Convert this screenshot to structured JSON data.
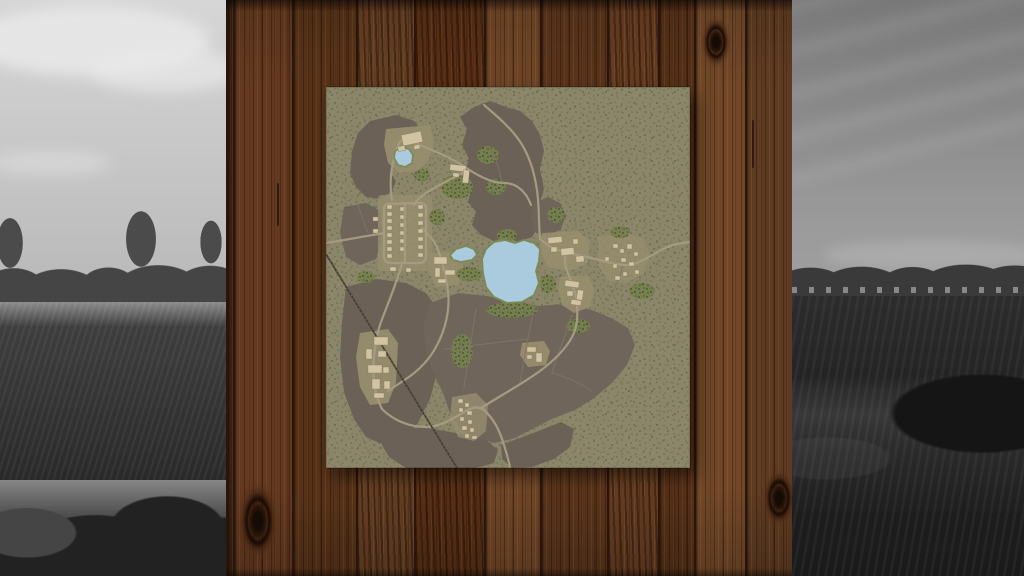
{
  "scene": {
    "width": 1024,
    "height": 576
  },
  "left_landscape": {
    "sky_top": "#d6d6d6",
    "sky_bottom": "#c0c0c0",
    "cloud": "#e9e9e9",
    "treeline": "#454545",
    "mist": "#8c8c8c",
    "field": "#3e3e3e",
    "field_dark": "#2a2a2a",
    "bush": "#222222"
  },
  "right_landscape": {
    "sky_top": "#787878",
    "sky_bottom": "#9b9b9b",
    "treeline": "#3a3a3a",
    "buildings": "#c8c8c8",
    "field": "#2c2c2c",
    "ridge": "#383838",
    "field_dark": "#1d1d1d"
  },
  "wall": {
    "x": 226,
    "width": 566,
    "seam": "#2a150a",
    "planks": [
      {
        "x": 226,
        "w": 7,
        "tone": "#3a2112"
      },
      {
        "x": 233,
        "w": 59,
        "tone": "#64391f"
      },
      {
        "x": 292,
        "w": 64,
        "tone": "#573218"
      },
      {
        "x": 356,
        "w": 58,
        "tone": "#6a4124",
        "streak": true
      },
      {
        "x": 414,
        "w": 70,
        "tone": "#5d3116",
        "streak": true
      },
      {
        "x": 484,
        "w": 56,
        "tone": "#6f4526"
      },
      {
        "x": 540,
        "w": 67,
        "tone": "#5a341b"
      },
      {
        "x": 607,
        "w": 51,
        "tone": "#6b3f22",
        "streak": true
      },
      {
        "x": 658,
        "w": 36,
        "tone": "#553017"
      },
      {
        "x": 694,
        "w": 51,
        "tone": "#714727"
      },
      {
        "x": 745,
        "w": 47,
        "tone": "#5e3a20"
      }
    ],
    "knots": [
      {
        "cx": 716,
        "cy": 42,
        "rx": 20,
        "ry": 34
      },
      {
        "cx": 258,
        "cy": 521,
        "rx": 27,
        "ry": 52
      },
      {
        "cx": 779,
        "cy": 498,
        "rx": 22,
        "ry": 38
      }
    ],
    "cracks": [
      {
        "x": 277,
        "y1": 183,
        "y2": 226
      },
      {
        "x": 752,
        "y1": 120,
        "y2": 168
      }
    ]
  },
  "map_poster": {
    "x": 326,
    "y": 87,
    "width": 364,
    "height": 381,
    "colors": {
      "ground": "#8b866a",
      "speckle": "#565c3b",
      "field": "#6b6156",
      "field_alt": "#6f655a",
      "clearing": "#978d6e",
      "shrub": "#76804d",
      "shrub_dot": "#49572f",
      "road": "#a59b82",
      "track": "#7f7567",
      "rail": "#443f32",
      "water": "#a9cbdd",
      "shore": "#7d8a55",
      "building": "#d0c4a2",
      "building_edge": "#877c60"
    },
    "fields": [
      {
        "d": "M 44,34 L 70,28 L 88,34 L 96,44 L 90,52 L 76,50 L 66,56 L 64,66 L 68,76 L 64,86 L 70,94 L 66,104 L 54,112 L 40,110 L 30,100 L 24,86 L 26,64 L 32,46 Z"
      },
      {
        "d": "M 134,30 L 148,20 L 164,14 L 180,20 L 194,24 L 206,34 L 214,48 L 218,64 L 214,82 L 218,102 L 212,122 L 215,136 L 206,150 L 192,155 L 180,150 L 168,154 L 155,148 L 146,138 L 150,125 L 142,115 L 146,100 L 138,88 L 143,72 L 136,58 L 141,42 Z"
      },
      {
        "d": "M 18,120 L 40,116 L 54,124 L 56,150 L 50,172 L 34,178 L 20,170 L 14,146 Z",
        "alt": true
      },
      {
        "d": "M 20,200 L 50,192 L 80,196 L 100,206 L 112,222 L 110,252 L 112,282 L 104,312 L 92,336 L 78,352 L 58,358 L 40,350 L 28,332 L 18,305 L 14,270 L 16,235 Z"
      },
      {
        "d": "M 104,216 L 132,206 L 160,209 L 186,213 L 212,219 L 240,217 L 266,223 L 285,231 L 302,241 L 309,258 L 301,278 L 286,296 L 268,311 L 249,323 L 228,331 L 208,341 L 189,351 L 169,356 L 149,351 L 134,341 L 124,326 L 117,306 L 108,288 L 100,264 L 97,240 Z",
        "alt": true
      },
      {
        "d": "M 62,346 L 96,340 L 130,346 L 160,353 L 172,363 L 168,376 L 150,381 L 80,381 L 63,370 L 56,358 Z"
      },
      {
        "d": "M 208,116 L 222,110 L 234,116 L 240,128 L 235,142 L 222,149 L 210,146 L 205,130 Z",
        "alt": true
      },
      {
        "d": "M 175,358 L 210,345 L 235,335 L 248,342 L 244,360 L 228,372 L 206,380 L 186,381 L 176,372 Z"
      }
    ],
    "clearings": [
      {
        "d": "M 60,42 L 104,38 L 108,56 L 102,74 L 92,84 L 74,86 L 62,76 L 58,58 Z"
      },
      {
        "d": "M 56,108 L 102,108 Q 106,108 106,112 L 106,180 Q 106,184 102,184 L 56,184 Q 52,184 52,180 L 52,112 Q 52,108 56,108 Z",
        "o": 0.8
      },
      {
        "d": "M 104,166 L 134,164 L 138,182 L 132,198 L 110,200 L 102,184 Z"
      },
      {
        "d": "M 216,146 L 252,144 L 264,154 L 262,176 L 244,184 L 222,180 L 214,162 Z"
      },
      {
        "d": "M 272,150 L 300,146 L 318,152 L 324,168 L 318,186 L 300,196 L 282,194 L 272,178 Z",
        "o": 0.75
      },
      {
        "d": "M 234,190 L 262,188 L 268,202 L 264,220 L 248,226 L 236,218 L 232,202 Z"
      },
      {
        "d": "M 34,246 L 62,242 L 72,256 L 70,296 L 62,316 L 44,318 L 34,300 L 30,270 Z"
      },
      {
        "d": "M 126,310 L 150,306 L 162,318 L 160,344 L 148,354 L 132,350 L 124,332 Z",
        "o": 0.8
      },
      {
        "d": "M 196,256 L 218,254 L 224,264 L 220,278 L 202,280 L 194,268 Z"
      }
    ],
    "shrubs": [
      [
        131,
        100,
        16,
        12
      ],
      [
        162,
        68,
        11,
        9
      ],
      [
        170,
        100,
        10,
        8
      ],
      [
        186,
        223,
        26,
        8
      ],
      [
        143,
        187,
        13,
        7
      ],
      [
        136,
        264,
        11,
        17
      ],
      [
        316,
        204,
        13,
        8
      ],
      [
        252,
        239,
        12,
        7
      ],
      [
        222,
        197,
        8,
        9
      ],
      [
        96,
        88,
        8,
        6
      ],
      [
        40,
        190,
        9,
        6
      ],
      [
        294,
        145,
        10,
        6
      ],
      [
        111,
        130,
        8,
        8
      ],
      [
        230,
        128,
        9,
        8
      ],
      [
        181,
        148,
        10,
        6
      ]
    ],
    "tracks": [
      "M 150,222 C 146,248 142,274 138,300",
      "M 208,222 C 202,248 198,272 194,296",
      "M 246,228 C 238,250 232,268 226,286",
      "M 118,262 L 200,252",
      "M 284,210 C 290,200 294,190 297,178",
      "M 176,96 C 174,84 170,72 164,60",
      "M 30,112 C 34,124 38,136 42,146",
      "M 226,286 C 240,290 254,296 266,304"
    ],
    "roads": [
      "M 78,52 C 98,60 122,68 142,82 C 154,90 166,96 178,96 C 190,96 200,104 205,118",
      "M 158,18 C 172,30 186,42 195,56 C 205,72 210,90 212,112 C 213,126 213,140 214,152",
      "M 214,152 C 224,162 238,166 252,168 C 270,171 284,177 297,178 C 312,179 325,168 339,161 C 348,157 356,156 364,155",
      "M 140,84 C 126,92 112,98 100,106 C 94,110 90,114 88,118",
      "M 62,117 L 94,116 Q 100,116 100,122 L 100,169 Q 100,176 93,176 L 65,176 Q 58,176 58,169 L 58,123 Q 58,117 62,117",
      "M 79,116 L 79,176",
      "M 58,146 C 40,149 20,153 0,156",
      "M 66,113 C 63,96 65,80 70,64 C 72,57 75,53 78,52",
      "M 76,176 C 72,192 66,206 60,222 C 56,232 52,242 50,254",
      "M 50,254 C 47,272 46,290 50,306 C 52,314 54,318 56,322",
      "M 56,322 C 68,334 84,340 100,340 C 114,340 126,332 138,325 C 146,320 152,319 158,323",
      "M 158,323 C 168,332 174,344 178,358 C 181,368 183,374 184,381",
      "M 155,321 C 174,309 196,297 214,284 C 230,272 242,260 248,246 C 252,235 252,222 250,210 C 248,200 244,192 241,184 C 239,178 238,172 240,168",
      "M 96,141 C 103,148 107,153 110,158 C 116,172 120,188 122,204 C 124,222 120,242 110,260 C 103,273 92,284 80,292 C 74,296 68,300 62,304"
    ],
    "railway": "M 0,167 L 131,381",
    "lakes": [
      "M 160,162 L 168,155 L 179,153 L 189,156 L 198,153 L 208,156 L 214,162 L 213,174 L 210,184 L 213,196 L 208,208 L 196,215 L 181,216 L 168,210 L 160,200 L 157,186 L 156,172 Z",
      "M 124,168 L 130,162 L 140,159 L 148,162 L 151,168 L 146,173 L 135,175 L 127,173 Z",
      "M 69,64 L 76,60 L 83,62 L 87,68 L 86,76 L 79,80 L 72,78 L 68,71 Z"
    ],
    "building_clusters": [
      {
        "name": "farm-nw",
        "rects": [
          [
            76,
            46,
            20,
            11,
            -12
          ],
          [
            72,
            59,
            7,
            5,
            -12
          ],
          [
            88,
            58,
            6,
            4,
            -12
          ]
        ]
      },
      {
        "name": "estate-n",
        "rects": [
          [
            124,
            78,
            16,
            6,
            6
          ],
          [
            137,
            83,
            6,
            13,
            6
          ],
          [
            127,
            86,
            6,
            4,
            6
          ]
        ]
      },
      {
        "name": "village-nw",
        "rects": [
          [
            61,
            118,
            5,
            4
          ],
          [
            61,
            125,
            5,
            4
          ],
          [
            61,
            132,
            5,
            4
          ],
          [
            61,
            139,
            5,
            4
          ],
          [
            61,
            146,
            5,
            4
          ],
          [
            61,
            153,
            5,
            4
          ],
          [
            61,
            160,
            5,
            4
          ],
          [
            61,
            167,
            5,
            4
          ],
          [
            74,
            120,
            4,
            4
          ],
          [
            74,
            128,
            4,
            4
          ],
          [
            74,
            136,
            4,
            4
          ],
          [
            74,
            144,
            4,
            4
          ],
          [
            74,
            152,
            4,
            4
          ],
          [
            74,
            160,
            4,
            4
          ],
          [
            92,
            118,
            5,
            4
          ],
          [
            92,
            126,
            5,
            4
          ],
          [
            92,
            134,
            5,
            4
          ],
          [
            92,
            142,
            5,
            4
          ],
          [
            92,
            150,
            5,
            4
          ],
          [
            92,
            158,
            5,
            4
          ],
          [
            92,
            166,
            5,
            4
          ],
          [
            64,
            180,
            6,
            4
          ],
          [
            80,
            181,
            5,
            4
          ],
          [
            47,
            130,
            5,
            4
          ],
          [
            47,
            142,
            5,
            4
          ]
        ]
      },
      {
        "name": "farm-w",
        "rects": [
          [
            108,
            170,
            13,
            7,
            0
          ],
          [
            109,
            181,
            5,
            9,
            0
          ],
          [
            119,
            183,
            10,
            5,
            0
          ],
          [
            112,
            192,
            8,
            4,
            0
          ]
        ]
      },
      {
        "name": "farm-g",
        "rects": [
          [
            222,
            150,
            14,
            6,
            -6
          ],
          [
            225,
            160,
            6,
            5,
            0
          ],
          [
            235,
            161,
            13,
            7,
            -6
          ],
          [
            247,
            152,
            5,
            5,
            0
          ],
          [
            250,
            169,
            8,
            6,
            -6
          ]
        ]
      },
      {
        "name": "hamlet-e",
        "rects": [
          [
            287,
            157,
            5,
            4,
            0
          ],
          [
            294,
            162,
            4,
            4,
            0
          ],
          [
            301,
            157,
            5,
            5,
            0
          ],
          [
            308,
            165,
            4,
            4,
            0
          ],
          [
            295,
            171,
            5,
            4,
            0
          ],
          [
            287,
            177,
            4,
            4,
            0
          ],
          [
            303,
            175,
            5,
            4,
            0
          ],
          [
            309,
            183,
            4,
            4,
            0
          ],
          [
            297,
            185,
            4,
            4,
            0
          ],
          [
            289,
            189,
            5,
            4,
            0
          ],
          [
            279,
            170,
            4,
            4,
            0
          ]
        ]
      },
      {
        "name": "farm-e",
        "rects": [
          [
            239,
            194,
            14,
            6,
            8
          ],
          [
            251,
            203,
            6,
            10,
            8
          ],
          [
            241,
            204,
            6,
            5,
            0
          ],
          [
            245,
            213,
            10,
            5,
            8
          ]
        ]
      },
      {
        "name": "farm-c",
        "rects": [
          [
            48,
            250,
            14,
            8,
            0
          ],
          [
            40,
            262,
            6,
            10,
            0
          ],
          [
            52,
            264,
            8,
            6,
            0
          ],
          [
            42,
            278,
            14,
            8,
            0
          ],
          [
            57,
            280,
            6,
            6,
            0
          ],
          [
            46,
            292,
            8,
            10,
            0
          ],
          [
            58,
            294,
            6,
            8,
            0
          ],
          [
            48,
            306,
            10,
            5,
            0
          ]
        ]
      },
      {
        "name": "village-d",
        "rects": [
          [
            132,
            312,
            5,
            4,
            0
          ],
          [
            139,
            316,
            4,
            4,
            0
          ],
          [
            133,
            321,
            4,
            4,
            0
          ],
          [
            141,
            324,
            5,
            4,
            0
          ],
          [
            134,
            330,
            4,
            4,
            0
          ],
          [
            142,
            333,
            4,
            4,
            0
          ],
          [
            136,
            339,
            5,
            4,
            0
          ],
          [
            144,
            341,
            4,
            4,
            0
          ],
          [
            139,
            347,
            4,
            4,
            0
          ],
          [
            146,
            349,
            5,
            3,
            0
          ]
        ]
      },
      {
        "name": "shed-se",
        "rects": [
          [
            201,
            260,
            9,
            5,
            0
          ],
          [
            210,
            266,
            6,
            9,
            0
          ],
          [
            201,
            268,
            5,
            4,
            0
          ]
        ]
      }
    ]
  }
}
